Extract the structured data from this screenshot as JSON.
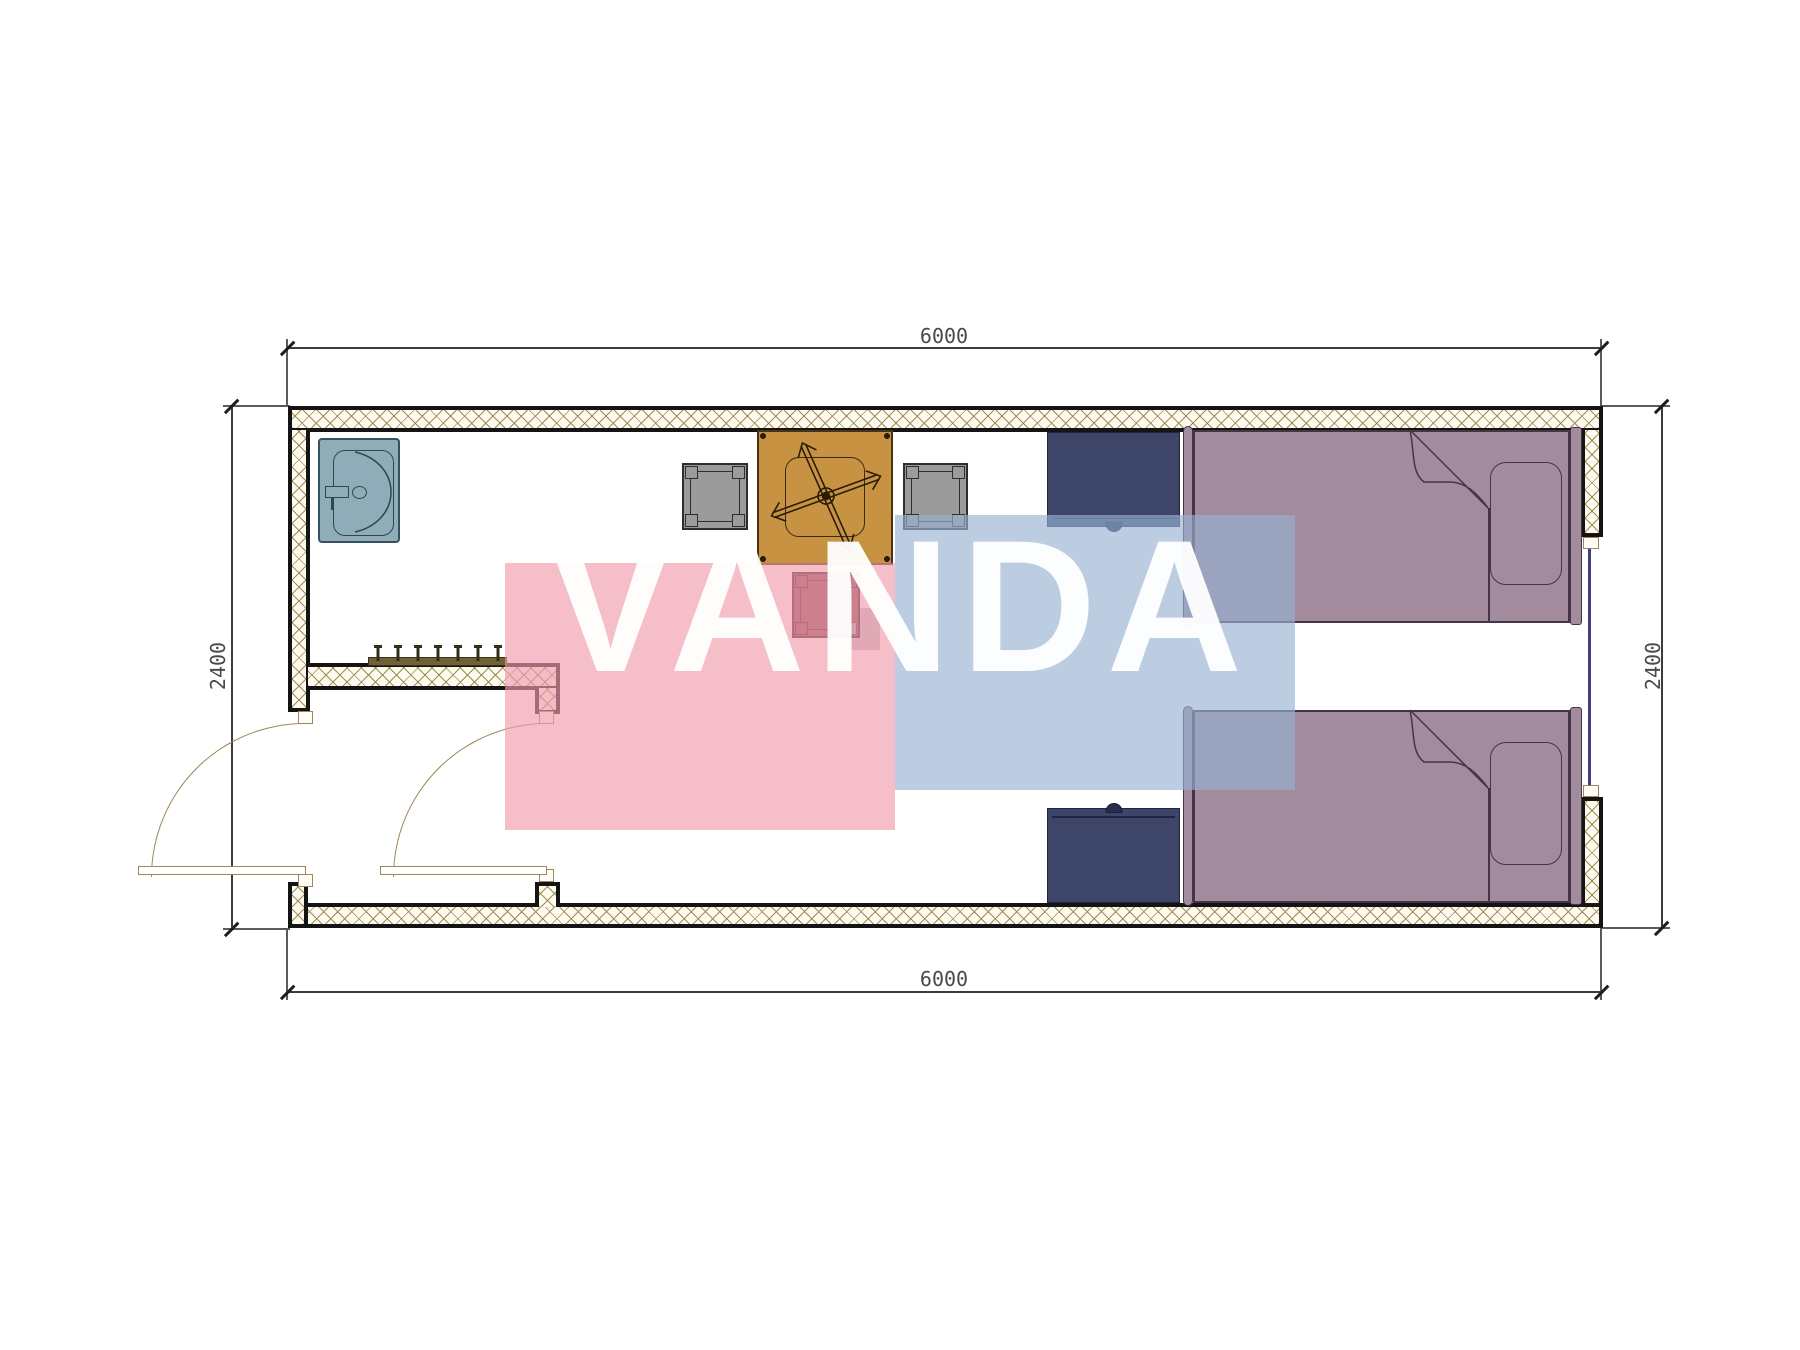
{
  "drawing": {
    "type": "architectural floor plan, top view (twin-bed container room)",
    "background": "#ffffff"
  },
  "dimensions": {
    "top": {
      "label": "6000"
    },
    "bottom": {
      "label": "6000"
    },
    "left": {
      "label": "2400"
    },
    "right": {
      "label": "2400"
    }
  },
  "watermark": {
    "text": "VANDA",
    "text_color": "#ffffff",
    "pink_block_color": "#f09bac",
    "blue_block_color": "#98b2d3"
  },
  "walls": {
    "outline_color": "#141414",
    "hatch_line_color": "#9b864d",
    "hatch_background": "#fdfaf0"
  },
  "window": {
    "glass_line_color": "#3f3f7d",
    "frame_color": "#9c8855"
  },
  "doors": {
    "swing_color": "#9c8855",
    "items": [
      {
        "name": "entry-door",
        "swing": "outward-left"
      },
      {
        "name": "interior-door",
        "swing": "into-vestibule"
      }
    ]
  },
  "furniture": {
    "washbasin": {
      "color": "#8fadb8",
      "outline": "#2f4750"
    },
    "coat_rack": {
      "color": "#6f6236",
      "hook_count": 7
    },
    "dining_table": {
      "color": "#c79343",
      "outline": "#4a3214",
      "symbol": "fan-cross"
    },
    "chairs": [
      {
        "id": "left",
        "color": "#9b9b9b"
      },
      {
        "id": "right",
        "color": "#9b9b9b"
      },
      {
        "id": "bottom",
        "color": "#8e4c58"
      }
    ],
    "desks": [
      {
        "id": "upper",
        "color": "#3d4568"
      },
      {
        "id": "lower",
        "color": "#3d4568"
      }
    ],
    "beds": [
      {
        "id": "upper",
        "color": "#a28b9c",
        "outline": "#463347"
      },
      {
        "id": "lower",
        "color": "#a28b9c",
        "outline": "#463347"
      }
    ]
  }
}
